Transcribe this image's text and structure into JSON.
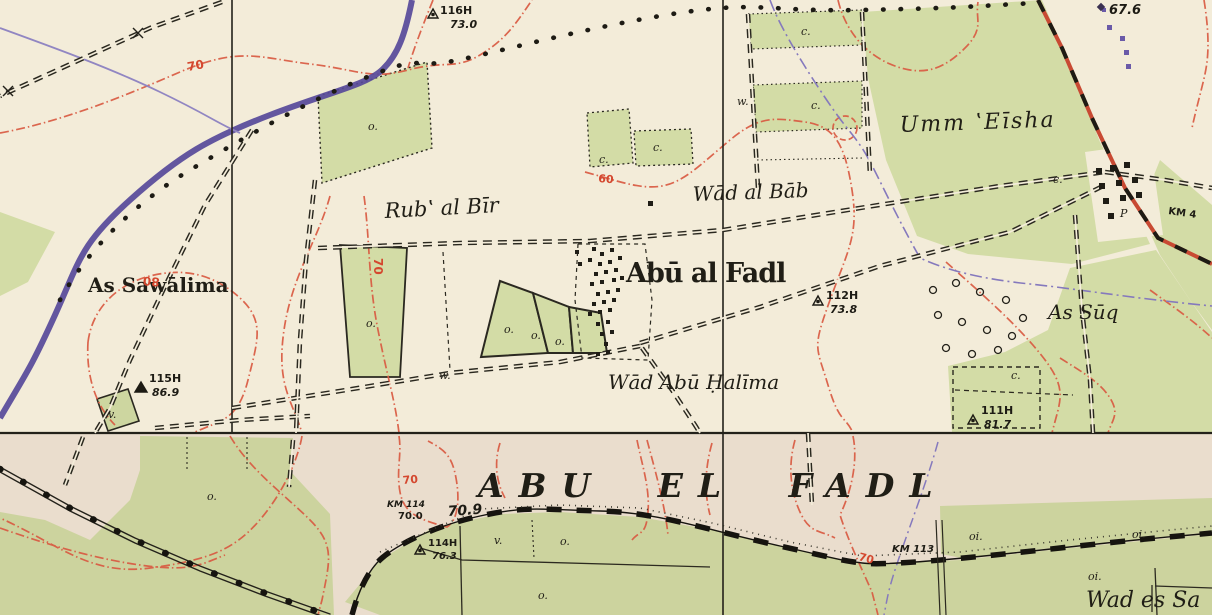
{
  "map": {
    "sheet_title": "ABU EL FADL",
    "labels": {
      "umm_eisha": "Umm ʽEīsha",
      "wad_al_bab": "Wād al Bāb",
      "rub_al_bir": "Rubʽ al Bīr",
      "abu_al_fadl": "Abū al Fadl",
      "as_sawalima": "As Sawālima",
      "as_suq": "As Sūq",
      "wad_abu_halima": "Wād Abū Ḥalīma",
      "wad_es_sa": "Wad es Sa"
    },
    "triangulation_points": [
      {
        "station": "116H",
        "elevation": "73.0"
      },
      {
        "station": "115H",
        "elevation": "86.9"
      },
      {
        "station": "112H",
        "elevation": "73.8"
      },
      {
        "station": "111H",
        "elevation": "81.7"
      },
      {
        "station": "114H",
        "elevation": "76.3"
      }
    ],
    "spot_heights": [
      {
        "value": "67.6"
      }
    ],
    "benchmarks": [
      {
        "value": "70.9"
      }
    ],
    "km_markers": [
      {
        "label": "KM 114",
        "elevation": "70.0"
      },
      {
        "label": "KM 113"
      },
      {
        "label": "KM 4"
      }
    ],
    "contour_labels": [
      "70",
      "80",
      "70",
      "60",
      "70",
      "70"
    ],
    "parcel_letters": [
      "o.",
      "c.",
      "c.",
      "w.",
      "c.",
      "c.",
      "o.",
      "o.",
      "o.",
      "o.",
      "v.",
      "w.",
      "c.",
      "c.",
      "v.",
      "o.",
      "o.",
      "oi.",
      "oi.",
      "oi.",
      "o.",
      "P"
    ],
    "colors": {
      "paper_upper_sheet": "#f3ecd9",
      "paper_lower_sheet": "#eaddcd",
      "cultivation_green_upper": "#d3dca6",
      "cultivation_green_lower": "#ccd39e",
      "contour_red": "#d95a42",
      "road_purple": "#57499a",
      "boundary_purple": "#8579bd",
      "ink_black": "#22201a"
    }
  }
}
